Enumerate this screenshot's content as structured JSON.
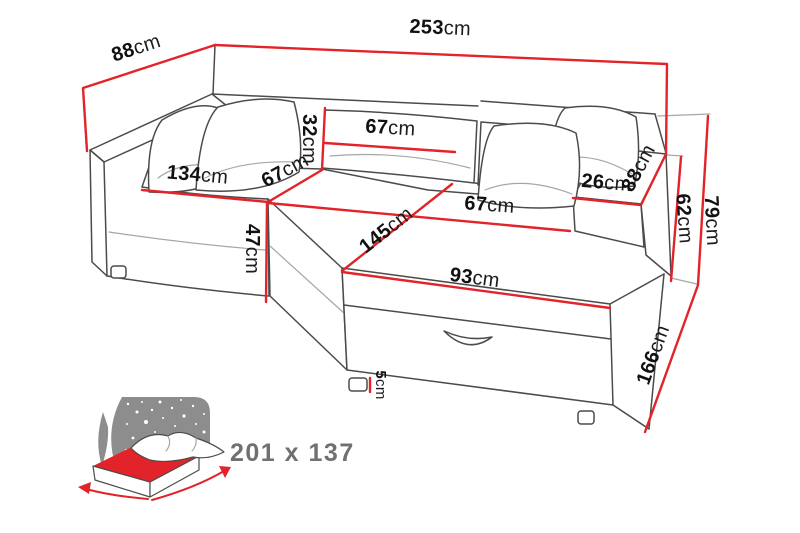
{
  "diagram": {
    "title": "corner-sofa-bed-dimensions",
    "unit": "cm",
    "dims": {
      "total_width": {
        "num": "253",
        "unit": "cm"
      },
      "side_depth": {
        "num": "88",
        "unit": "cm"
      },
      "backrest_height": {
        "num": "32",
        "unit": "cm"
      },
      "backrest_width": {
        "num": "67",
        "unit": "cm"
      },
      "left_seat_width": {
        "num": "134",
        "unit": "cm"
      },
      "left_seat_depth": {
        "num": "67",
        "unit": "cm"
      },
      "seat_height": {
        "num": "47",
        "unit": "cm"
      },
      "chaise_length": {
        "num": "145",
        "unit": "cm"
      },
      "right_seat_width": {
        "num": "67",
        "unit": "cm"
      },
      "chaise_front_width": {
        "num": "93",
        "unit": "cm"
      },
      "armrest_width": {
        "num": "26",
        "unit": "cm"
      },
      "armrest_depth": {
        "num": "88",
        "unit": "cm"
      },
      "armrest_height": {
        "num": "62",
        "unit": "cm"
      },
      "total_height": {
        "num": "79",
        "unit": "cm"
      },
      "chaise_total_length": {
        "num": "166",
        "unit": "cm"
      },
      "leg_height": {
        "num": "5",
        "unit": "cm"
      }
    },
    "bed_icon": {
      "sleeping_area_label": "201 x 137"
    },
    "colors": {
      "dimension_red": "#e2232a",
      "outline_gray": "#4b4b4b",
      "soft_gray": "#a6a6a6",
      "icon_gray": "#8d8d8d",
      "label_gray": "#707070",
      "ink": "#111111",
      "background": "#ffffff"
    }
  }
}
